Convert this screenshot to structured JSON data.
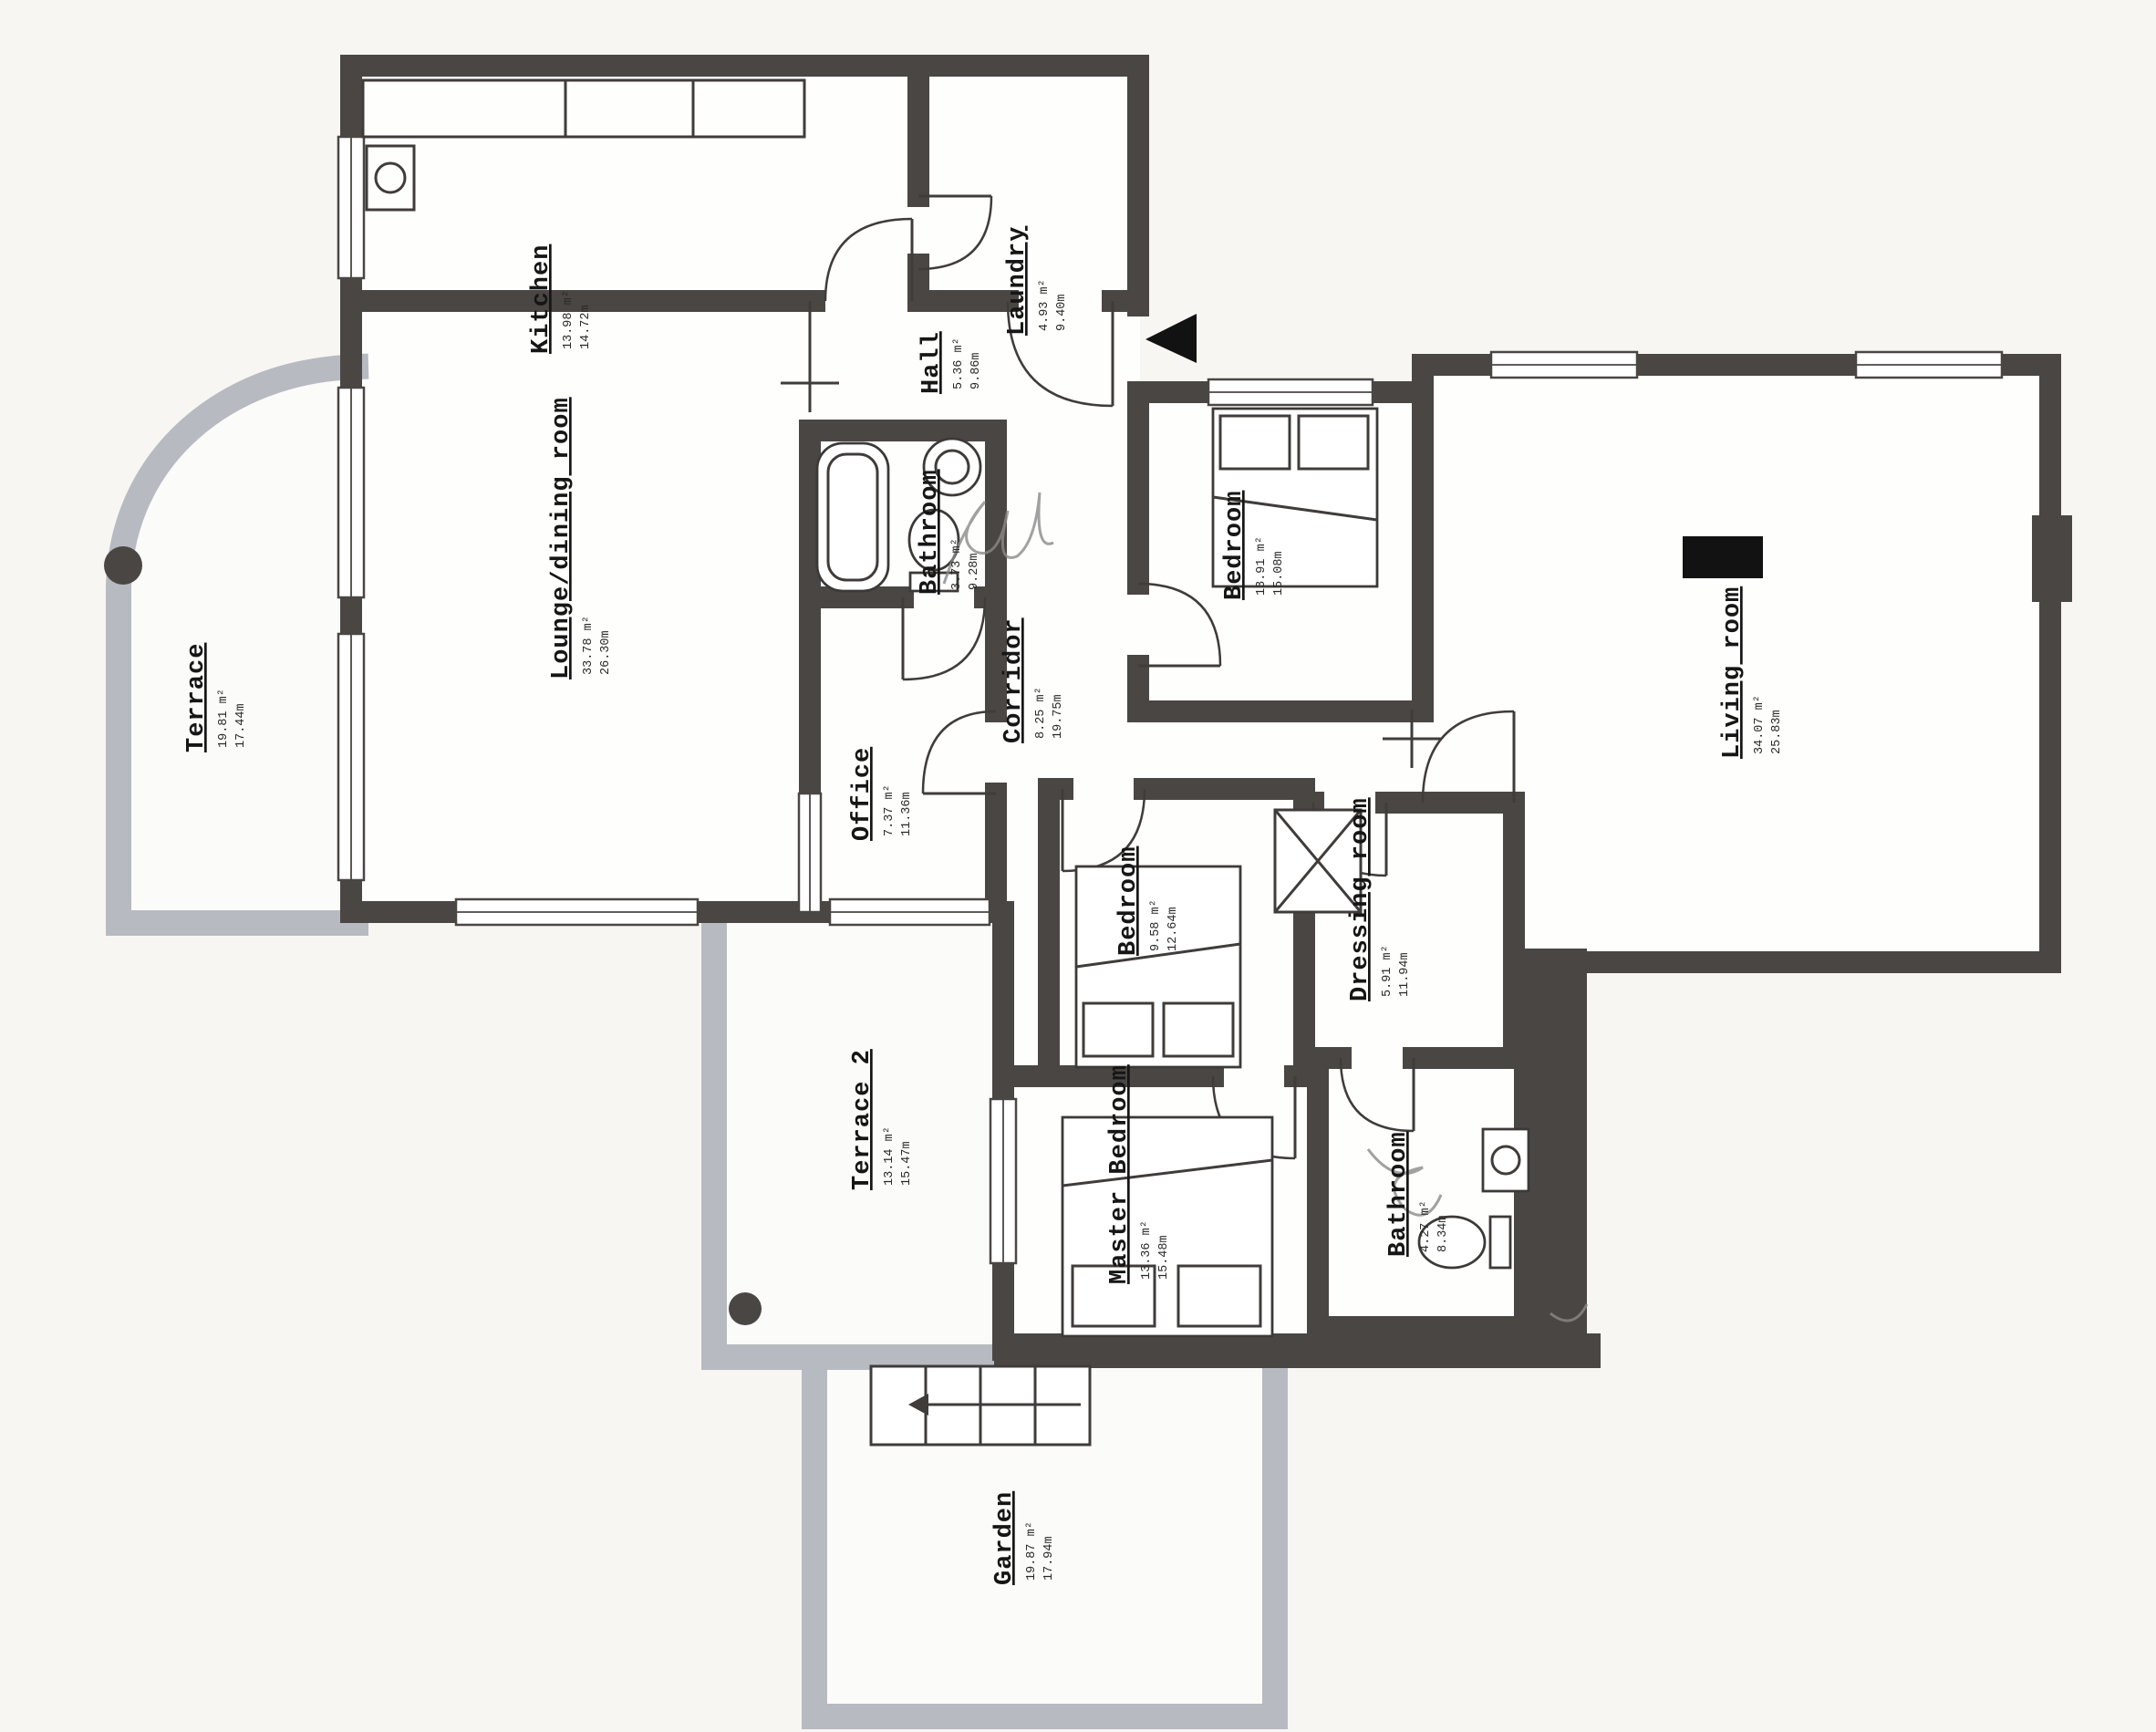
{
  "document": {
    "type": "Apartment floor plan",
    "style": "scanned architectural drawing"
  },
  "colors": {
    "wall_dark": "#4a4643",
    "wall_light": "#b7bac1",
    "paper": "#f7f6f3",
    "ink": "#161616"
  },
  "symbols": {
    "north_arrow": "left-pointing solid triangle at entrance",
    "handwriting": "illegible pen scribble over bathrooms"
  },
  "rooms": {
    "kitchen": {
      "name": "Kitchen",
      "area": "13.98 m²",
      "perimeter": "14.72m"
    },
    "laundry": {
      "name": "Laundry",
      "area": "4.93 m²",
      "perimeter": "9.40m"
    },
    "hall": {
      "name": "Hall",
      "area": "5.36 m²",
      "perimeter": "9.86m"
    },
    "bathroom": {
      "name": "Bathroom",
      "area": "3.73 m²",
      "perimeter": "9.28m"
    },
    "lounge_dining": {
      "name": "Lounge/dining room",
      "area": "33.78 m²",
      "perimeter": "26.30m"
    },
    "terrace": {
      "name": "Terrace",
      "area": "19.81 m²",
      "perimeter": "17.44m"
    },
    "corridor": {
      "name": "Corridor",
      "area": "8.25 m²",
      "perimeter": "19.75m"
    },
    "office": {
      "name": "Office",
      "area": "7.37 m²",
      "perimeter": "11.36m"
    },
    "bedroom_top": {
      "name": "Bedroom",
      "area": "13.91 m²",
      "perimeter": "15.08m"
    },
    "living_room": {
      "name": "Living room",
      "area": "34.07 m²",
      "perimeter": "25.83m"
    },
    "bedroom_mid": {
      "name": "Bedroom",
      "area": "9.58 m²",
      "perimeter": "12.64m"
    },
    "dressing": {
      "name": "Dressing room",
      "area": "5.91 m²",
      "perimeter": "11.94m"
    },
    "master": {
      "name": "Master Bedroom",
      "area": "13.36 m²",
      "perimeter": "15.48m"
    },
    "bathroom2": {
      "name": "Bathroom",
      "area": "4.27 m²",
      "perimeter": "8.34m"
    },
    "terrace2": {
      "name": "Terrace 2",
      "area": "13.14 m²",
      "perimeter": "15.47m"
    },
    "garden": {
      "name": "Garden",
      "area": "19.87 m²",
      "perimeter": "17.94m"
    }
  }
}
